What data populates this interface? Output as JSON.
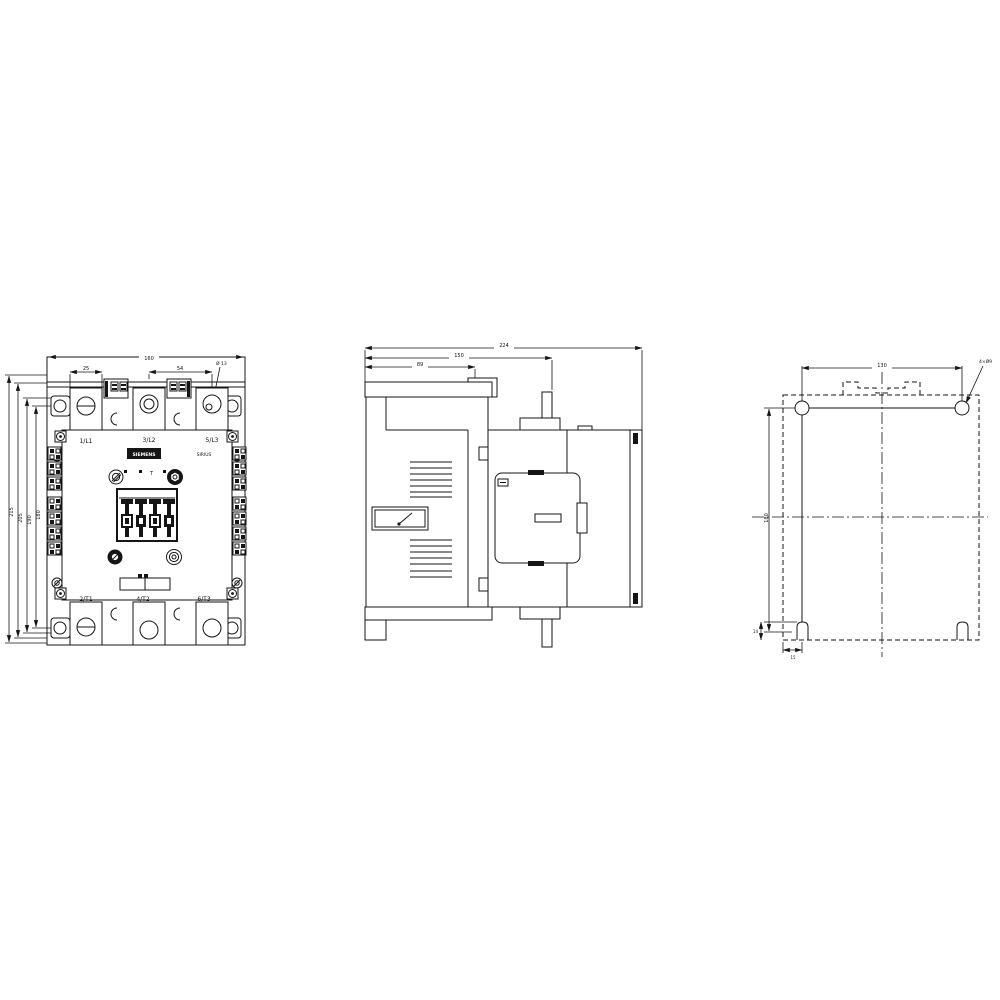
{
  "drawing": {
    "front": {
      "terminals_top": [
        "1/L1",
        "3/L2",
        "5/L3"
      ],
      "terminals_bottom": [
        "2/T1",
        "4/T2",
        "6/T3"
      ],
      "brand_label": "SIEMENS",
      "series_label": "SIRIUS",
      "coil_mark": "T",
      "dim_overall_width": "160",
      "dim_terminal_width": "25",
      "dim_pole_pitch": "54",
      "dim_hole_dia": "Ø 13",
      "dim_height_outer": "215",
      "dim_height_body": "205",
      "dim_height_frame": "190",
      "dim_hole_spacing_v": "180"
    },
    "side": {
      "dim_depth_overall": "224",
      "dim_depth_body": "150",
      "dim_depth_front": "89"
    },
    "mounting": {
      "dim_hole_pitch_h": "130",
      "dim_hole_pitch_v": "180",
      "hole_note": "4×Ø9",
      "dim_slot_height": "14",
      "dim_slot_offset": "15"
    }
  }
}
